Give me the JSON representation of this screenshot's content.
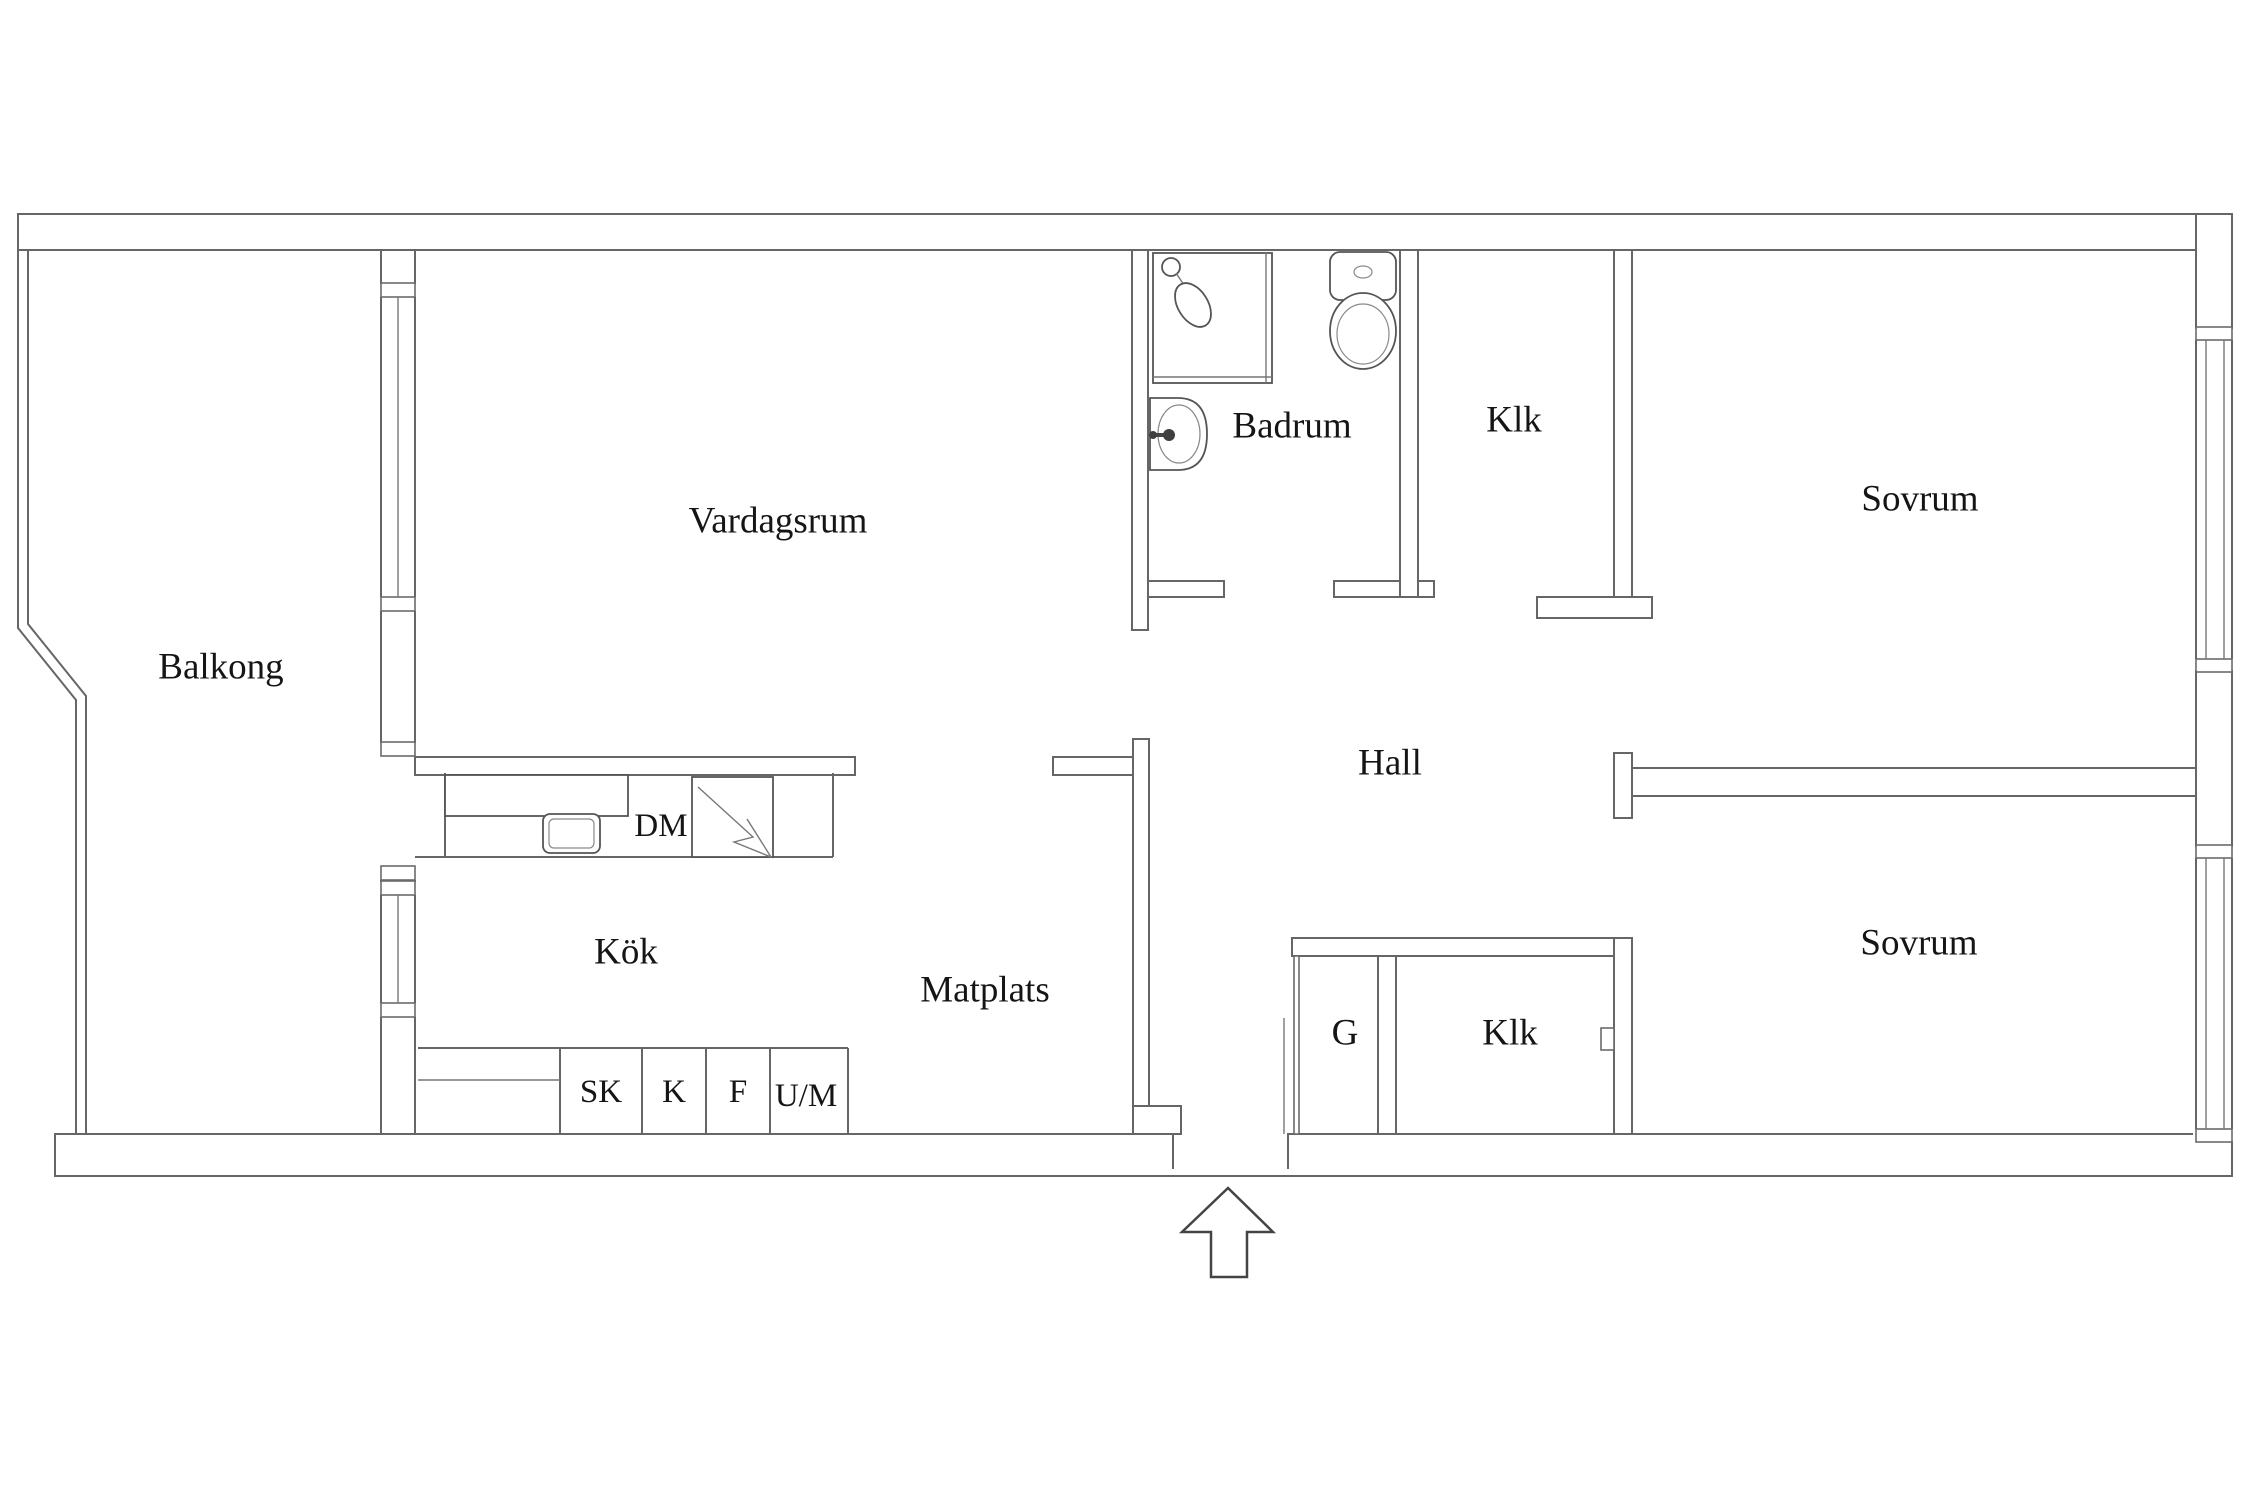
{
  "document": {
    "type": "apartment-floor-plan",
    "language": "Swedish"
  },
  "colors": {
    "background": "#ffffff",
    "wall_line": "#666666",
    "fixture_line": "#555555",
    "text": "#151515",
    "arrow_line": "#444444"
  },
  "rooms": [
    {
      "key": "balkong",
      "label": "Balkong"
    },
    {
      "key": "vardagsrum",
      "label": "Vardagsrum"
    },
    {
      "key": "badrum",
      "label": "Badrum"
    },
    {
      "key": "klk-top",
      "label": "Klk"
    },
    {
      "key": "sovrum-top",
      "label": "Sovrum"
    },
    {
      "key": "hall",
      "label": "Hall"
    },
    {
      "key": "kok",
      "label": "Kök"
    },
    {
      "key": "matplats",
      "label": "Matplats"
    },
    {
      "key": "garderob",
      "label": "G"
    },
    {
      "key": "klk-bottom",
      "label": "Klk"
    },
    {
      "key": "sovrum-bottom",
      "label": "Sovrum"
    }
  ],
  "appliances": [
    {
      "key": "dm",
      "label": "DM"
    },
    {
      "key": "sk",
      "label": "SK"
    },
    {
      "key": "k",
      "label": "K"
    },
    {
      "key": "f",
      "label": "F"
    },
    {
      "key": "um",
      "label": "U/M"
    }
  ],
  "fixture_icons": [
    "shower-icon",
    "shower-head-icon",
    "toilet-icon",
    "washbasin-icon",
    "kitchen-sink-icon",
    "stove-lightning-icon",
    "entrance-arrow-icon"
  ],
  "labels": [
    {
      "id": "room-label-balkong",
      "text": "Balkong",
      "x": 221,
      "y": 667,
      "size": 37
    },
    {
      "id": "room-label-vardagsrum",
      "text": "Vardagsrum",
      "x": 778,
      "y": 521,
      "size": 37
    },
    {
      "id": "room-label-badrum",
      "text": "Badrum",
      "x": 1292,
      "y": 426,
      "size": 37
    },
    {
      "id": "room-label-klk-top",
      "text": "Klk",
      "x": 1514,
      "y": 420,
      "size": 37
    },
    {
      "id": "room-label-sovrum-top",
      "text": "Sovrum",
      "x": 1920,
      "y": 499,
      "size": 37
    },
    {
      "id": "room-label-hall",
      "text": "Hall",
      "x": 1390,
      "y": 763,
      "size": 37
    },
    {
      "id": "room-label-kok",
      "text": "Kök",
      "x": 626,
      "y": 952,
      "size": 37
    },
    {
      "id": "room-label-matplats",
      "text": "Matplats",
      "x": 985,
      "y": 990,
      "size": 37
    },
    {
      "id": "room-label-garderob",
      "text": "G",
      "x": 1345,
      "y": 1033,
      "size": 37
    },
    {
      "id": "room-label-klk-bottom",
      "text": "Klk",
      "x": 1510,
      "y": 1033,
      "size": 37
    },
    {
      "id": "room-label-sovrum-bottom",
      "text": "Sovrum",
      "x": 1919,
      "y": 943,
      "size": 37
    },
    {
      "id": "appliance-label-dm",
      "text": "DM",
      "x": 661,
      "y": 826,
      "size": 33
    },
    {
      "id": "appliance-label-sk",
      "text": "SK",
      "x": 601,
      "y": 1092,
      "size": 33
    },
    {
      "id": "appliance-label-k",
      "text": "K",
      "x": 674,
      "y": 1092,
      "size": 33
    },
    {
      "id": "appliance-label-f",
      "text": "F",
      "x": 738,
      "y": 1092,
      "size": 33
    },
    {
      "id": "appliance-label-um",
      "text": "U/M",
      "x": 806,
      "y": 1096,
      "size": 33
    }
  ]
}
